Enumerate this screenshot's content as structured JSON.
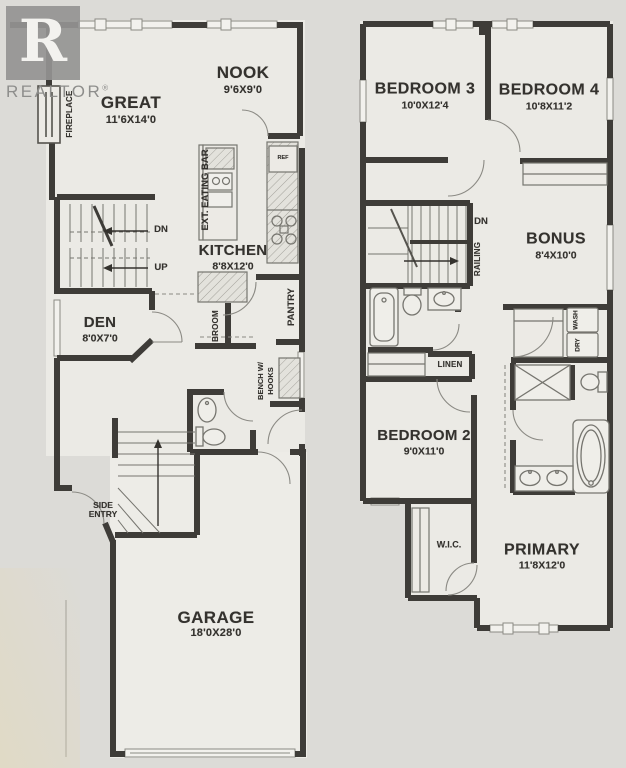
{
  "watermark": {
    "logo_letter": "R",
    "brand": "REALTOR",
    "reg": "®"
  },
  "main_floor": {
    "fireplace": "FIREPLACE",
    "great": {
      "name": "GREAT",
      "dims": "11'6X14'0"
    },
    "nook": {
      "name": "NOOK",
      "dims": "9'6X9'0"
    },
    "ext_eating_bar": "EXT. EATING BAR",
    "ref": "REF",
    "kitchen": {
      "name": "KITCHEN",
      "dims": "8'8X12'0"
    },
    "dn": "DN",
    "up": "UP",
    "den": {
      "name": "DEN",
      "dims": "8'0X7'0"
    },
    "broom": "BROOM",
    "pantry": "PANTRY",
    "bench_line1": "BENCH W/",
    "bench_line2": "HOOKS",
    "side_entry": "SIDE ENTRY",
    "garage": {
      "name": "GARAGE",
      "dims": "18'0X28'0"
    }
  },
  "upper_floor": {
    "bedroom3": {
      "name": "BEDROOM 3",
      "dims": "10'0X12'4"
    },
    "bedroom4": {
      "name": "BEDROOM 4",
      "dims": "10'8X11'2"
    },
    "dn": "DN",
    "railing": "RAILING",
    "bonus": {
      "name": "BONUS",
      "dims": "8'4X10'0"
    },
    "linen": "LINEN",
    "wash": "WASH",
    "dry": "DRY",
    "bedroom2": {
      "name": "BEDROOM 2",
      "dims": "9'0X11'0"
    },
    "wic": "W.I.C.",
    "primary": {
      "name": "PRIMARY",
      "dims": "11'8X12'0"
    }
  },
  "colors": {
    "wall": "#3e3c38",
    "paper": "#ebeae5",
    "line": "#87867f",
    "text": "#34322e"
  }
}
